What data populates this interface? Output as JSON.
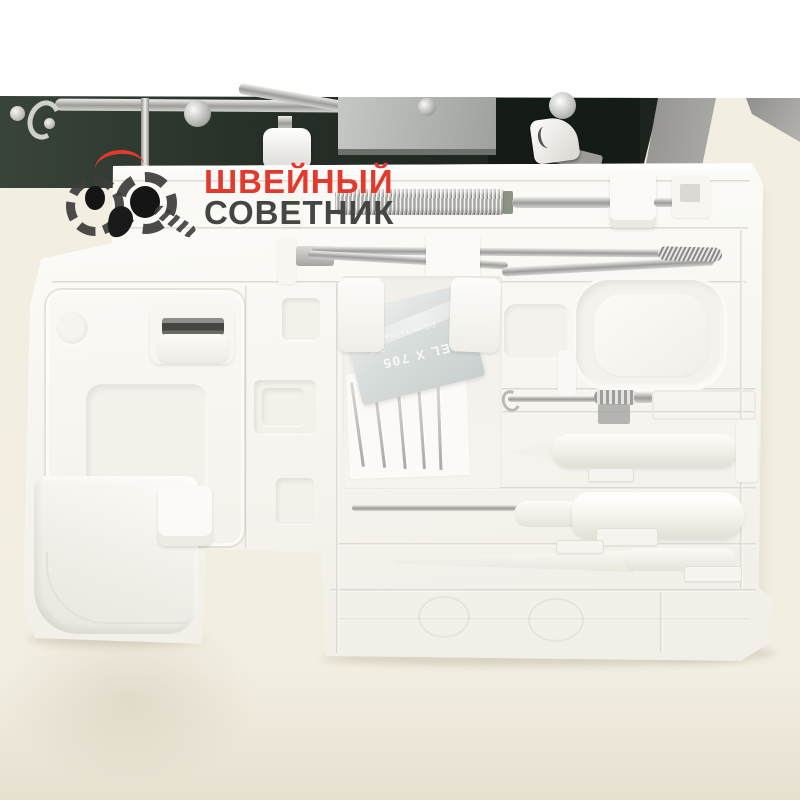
{
  "colors": {
    "page_bg": "#f2eee2",
    "top_bg": "#ffffff",
    "machine_dark": "#232b24",
    "machine_gray": "#9c9c9a",
    "metal": "#c9cbc8",
    "tray_white": "#fbfaf7",
    "tray_shadow": "#e6e3da",
    "logo_red": "#e23a2e",
    "logo_dark": "#454543",
    "case_gray": "#dde1e0"
  },
  "watermark": {
    "line1": "ШВЕЙНЫЙ",
    "line2": "СОВЕТНИК"
  },
  "needle_case": {
    "model": "EL X 705",
    "size": "B F",
    "origin": "DE IN TAIWA"
  }
}
